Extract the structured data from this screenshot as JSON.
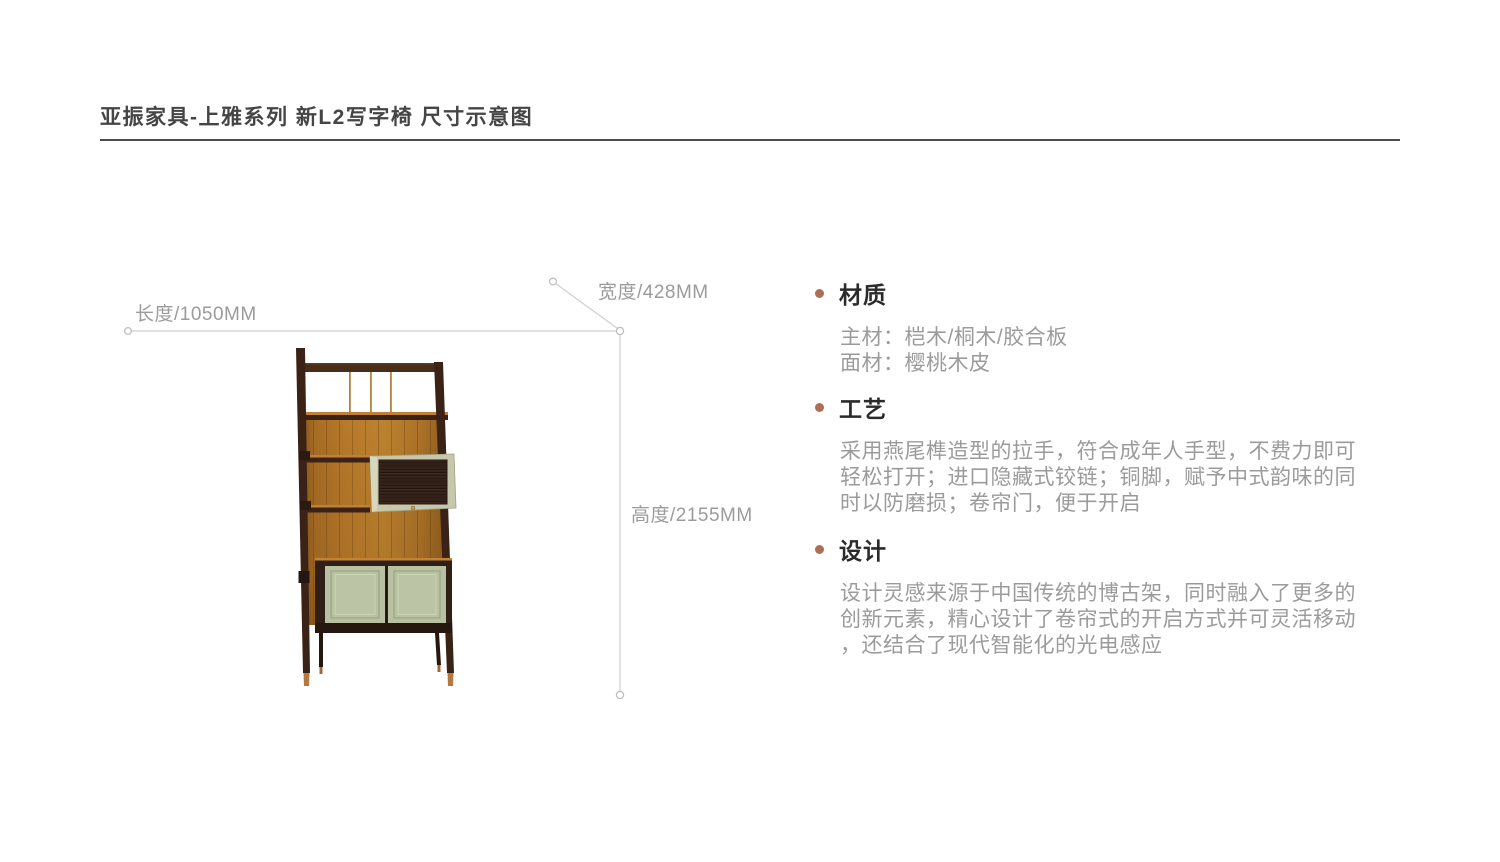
{
  "page": {
    "title": "亚振家具-上雅系列 新L2写字椅 尺寸示意图",
    "background_color": "#ffffff",
    "divider_color": "#4d4d4d"
  },
  "dimensions": {
    "length_label": "长度/1050MM",
    "width_label": "宽度/428MM",
    "height_label": "高度/2155MM",
    "line_color": "#cfcfcf",
    "label_color": "#9b9b9b"
  },
  "illustration": {
    "subject": "博古架式书柜 (bookshelf cabinet front view)",
    "frame_wood_color": "#3a2217",
    "back_panel_color": "#b5762a",
    "box_frame_color": "#c6c7ab",
    "tambour_door_color": "#33211a",
    "door_color": "#b9c1a3",
    "copper_feet_color": "#b5793f",
    "knob_color": "#c59a55"
  },
  "specs": {
    "accent_bullet_color": "#ad6e55",
    "sections": [
      {
        "heading": "材质",
        "lines": [
          "主材：桤木/桐木/胶合板",
          "面材：樱桃木皮"
        ]
      },
      {
        "heading": "工艺",
        "lines": [
          "采用燕尾榫造型的拉手，符合成年人手型，不费力即可",
          "轻松打开；进口隐藏式铰链；铜脚，赋予中式韵味的同",
          "时以防磨损；卷帘门，便于开启"
        ]
      },
      {
        "heading": "设计",
        "lines": [
          "设计灵感来源于中国传统的博古架，同时融入了更多的",
          "创新元素，精心设计了卷帘式的开启方式并可灵活移动",
          "，还结合了现代智能化的光电感应"
        ]
      }
    ]
  }
}
